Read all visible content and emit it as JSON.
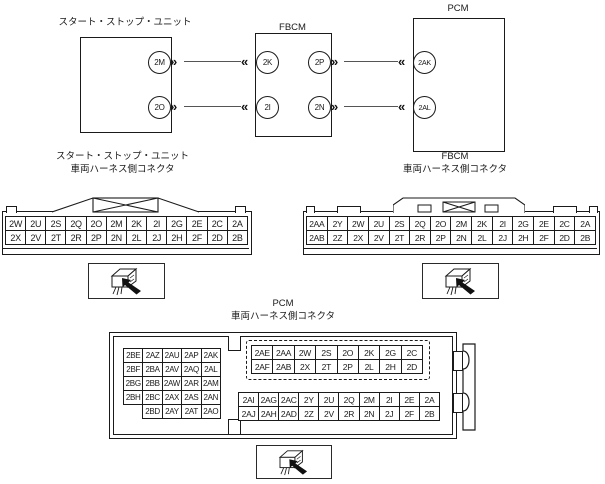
{
  "diagram": {
    "chevron_out": "»",
    "chevron_in": "«",
    "boxes": {
      "start_stop": {
        "label": "スタート・ストップ・ユニット",
        "pins_right": [
          "2M",
          "2O"
        ]
      },
      "fbcm": {
        "label": "FBCM",
        "pins_left": [
          "2K",
          "2I"
        ],
        "pins_right": [
          "2P",
          "2N"
        ]
      },
      "pcm": {
        "label": "PCM",
        "pins_left": [
          "2AK",
          "2AL"
        ]
      }
    }
  },
  "ss_connector": {
    "title_line1": "スタート・ストップ・ユニット",
    "title_line2": "車両ハーネス側コネクタ",
    "rows": [
      [
        "2W",
        "2U",
        "2S",
        "2Q",
        "2O",
        "2M",
        "2K",
        "2I",
        "2G",
        "2E",
        "2C",
        "2A"
      ],
      [
        "2X",
        "2V",
        "2T",
        "2R",
        "2P",
        "2N",
        "2L",
        "2J",
        "2H",
        "2F",
        "2D",
        "2B"
      ]
    ]
  },
  "fbcm_connector": {
    "title_line1": "FBCM",
    "title_line2": "車両ハーネス側コネクタ",
    "rows": [
      [
        "2AA",
        "2Y",
        "2W",
        "2U",
        "2S",
        "2Q",
        "2O",
        "2M",
        "2K",
        "2I",
        "2G",
        "2E",
        "2C",
        "2A"
      ],
      [
        "2AB",
        "2Z",
        "2X",
        "2V",
        "2T",
        "2R",
        "2P",
        "2N",
        "2L",
        "2J",
        "2H",
        "2F",
        "2D",
        "2B"
      ]
    ]
  },
  "pcm_connector": {
    "title_line1": "PCM",
    "title_line2": "車両ハーネス側コネクタ",
    "left_block": [
      [
        "2BE",
        "2AZ",
        "2AU",
        "2AP",
        "2AK"
      ],
      [
        "2BF",
        "2BA",
        "2AV",
        "2AQ",
        "2AL"
      ],
      [
        "2BG",
        "2BB",
        "2AW",
        "2AR",
        "2AM"
      ],
      [
        "2BH",
        "2BC",
        "2AX",
        "2AS",
        "2AN"
      ],
      [
        "",
        "2BD",
        "2AY",
        "2AT",
        "2AO"
      ]
    ],
    "top_right_block": [
      [
        "2AE",
        "2AA",
        "2W",
        "2S",
        "2O",
        "2K",
        "2G",
        "2C"
      ],
      [
        "2AF",
        "2AB",
        "2X",
        "2T",
        "2P",
        "2L",
        "2H",
        "2D"
      ]
    ],
    "bottom_right_block": [
      [
        "2AI",
        "2AG",
        "2AC",
        "2Y",
        "2U",
        "2Q",
        "2M",
        "2I",
        "2E",
        "2A"
      ],
      [
        "2AJ",
        "2AH",
        "2AD",
        "2Z",
        "2V",
        "2R",
        "2N",
        "2J",
        "2F",
        "2B"
      ]
    ]
  },
  "colors": {
    "line": "#1a1a1a",
    "wire": "#555555",
    "background": "#ffffff"
  }
}
